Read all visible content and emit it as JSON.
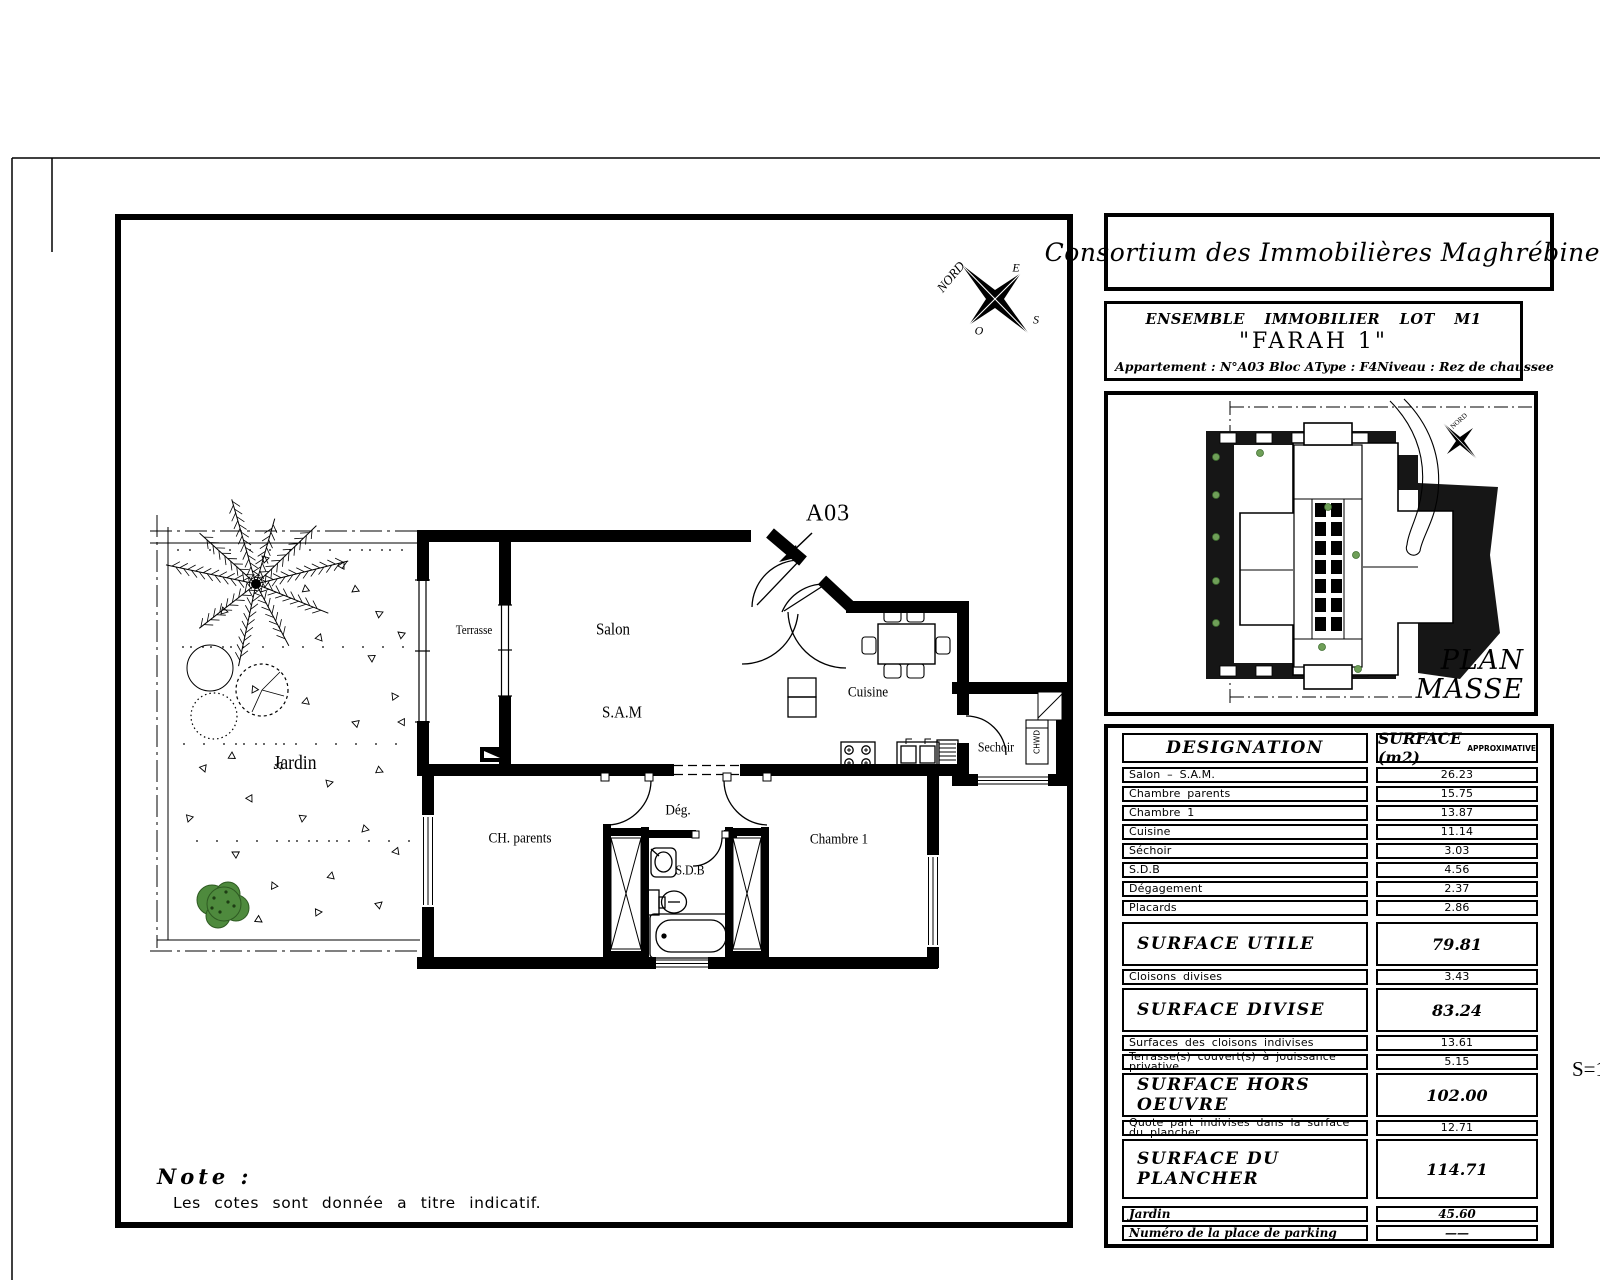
{
  "sheet": {
    "scale": "S=1",
    "note_title": "Note :",
    "note_body": "Les cotes sont donnée a titre indicatif."
  },
  "title_block": {
    "company": "Consortium des Immobilières Maghrébines"
  },
  "info_block": {
    "line1": "ENSEMBLE IMMOBILIER LOT M1",
    "project": "\"FARAH 1\"",
    "apartment": "Appartement :  N°A03 Bloc A",
    "type": "Type :  F4",
    "level": "Niveau :  Rez de chaussee"
  },
  "site_plan": {
    "title1": "PLAN",
    "title2": "MASSE",
    "north": "NORD"
  },
  "floor_plan": {
    "unit": "A03",
    "compass": {
      "n": "NORD",
      "e": "E",
      "w": "O",
      "s": "S"
    },
    "labels": {
      "jardin": "Jardin",
      "terrasse": "Terrasse",
      "salon": "Salon",
      "sam": "S.A.M",
      "cuisine": "Cuisine",
      "sechoir": "Sechoir",
      "chwd": "CHWD",
      "ch_parents": "CH. parents",
      "deg": "Dég.",
      "sdb": "S.D.B",
      "chambre1": "Chambre 1"
    }
  },
  "surface_table": {
    "header_designation": "DESIGNATION",
    "header_surface": "SURFACE  (m2)",
    "header_surface_small": "APPROXIMATIVE",
    "rows": [
      {
        "label": "Salon – S.A.M.",
        "value": "26.23",
        "style": "r"
      },
      {
        "label": "Chambre  parents",
        "value": "15.75",
        "style": "r"
      },
      {
        "label": "Chambre  1",
        "value": "13.87",
        "style": "r"
      },
      {
        "label": "Cuisine",
        "value": "11.14",
        "style": "r"
      },
      {
        "label": "Séchoir",
        "value": "3.03",
        "style": "r"
      },
      {
        "label": "S.D.B",
        "value": "4.56",
        "style": "r"
      },
      {
        "label": "Dégagement",
        "value": "2.37",
        "style": "r"
      },
      {
        "label": "Placards",
        "value": "2.86",
        "style": "r"
      },
      {
        "label": "SURFACE  UTILE",
        "value": "79.81",
        "style": "t"
      },
      {
        "label": "Cloisons  divises",
        "value": "3.43",
        "style": "r"
      },
      {
        "label": "SURFACE  DIVISE",
        "value": "83.24",
        "style": "t"
      },
      {
        "label": "Surfaces  des  cloisons  indivises",
        "value": "13.61",
        "style": "r"
      },
      {
        "label": "Terrasse(s)  couvert(s)  à  jouissance  privative",
        "value": "5.15",
        "style": "r"
      },
      {
        "label": "SURFACE  HORS  OEUVRE",
        "value": "102.00",
        "style": "t"
      },
      {
        "label": "Quote part indivises dans la surface du plancher",
        "value": "12.71",
        "style": "r"
      },
      {
        "label": "SURFACE  DU  PLANCHER",
        "value": "114.71",
        "style": "tt"
      },
      {
        "label": "Jardin",
        "value": "45.60",
        "style": "it"
      },
      {
        "label": "Numéro de la place de parking",
        "value": "——",
        "style": "it"
      }
    ]
  }
}
